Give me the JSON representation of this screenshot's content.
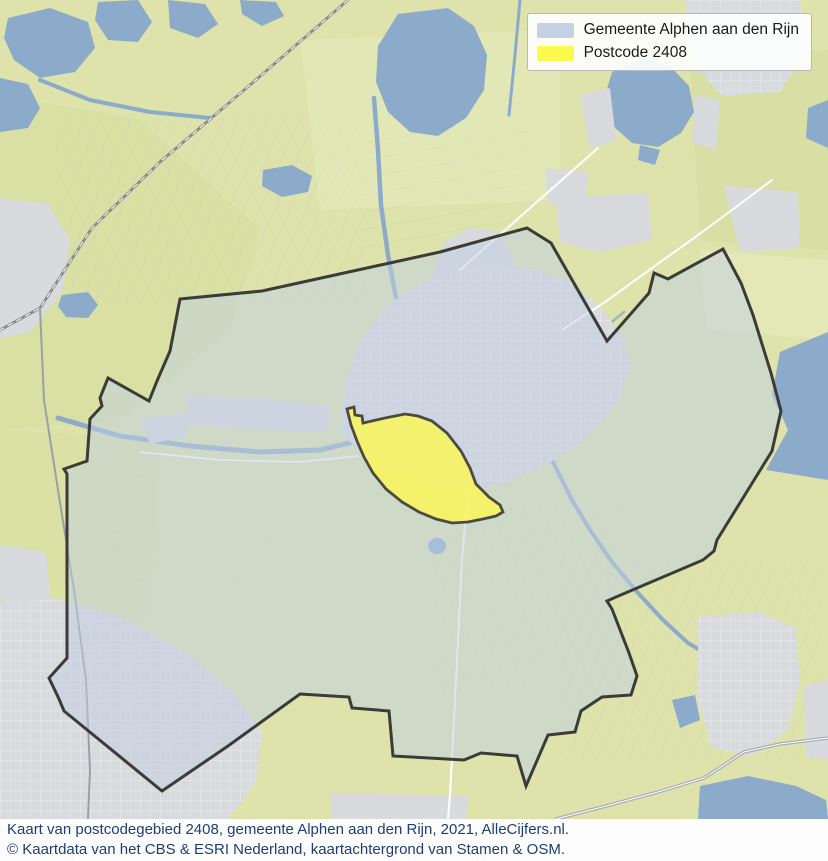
{
  "legend": {
    "items": [
      {
        "label": "Gemeente Alphen aan den Rijn",
        "color": "#c6d2e4"
      },
      {
        "label": "Postcode 2408",
        "color": "#fcf94f"
      }
    ]
  },
  "caption": {
    "line1": "Kaart van postcodegebied 2408, gemeente Alphen aan den Rijn, 2021, AlleCijfers.nl.",
    "line2": "© Kaartdata van het CBS & ESRI Nederland, kaartachtergrond van Stamen & OSM."
  },
  "map": {
    "colors": {
      "fields": "#dde3ab",
      "water": "#8caac9",
      "urban": "#d8dade",
      "municipality_fill": "rgba(193,208,227,0.52)",
      "municipality_border": "#3b3b38",
      "postcode_fill": "rgba(250,246,90,0.85)",
      "postcode_border": "#4a4a40",
      "caption_text": "#1d3f72"
    }
  }
}
